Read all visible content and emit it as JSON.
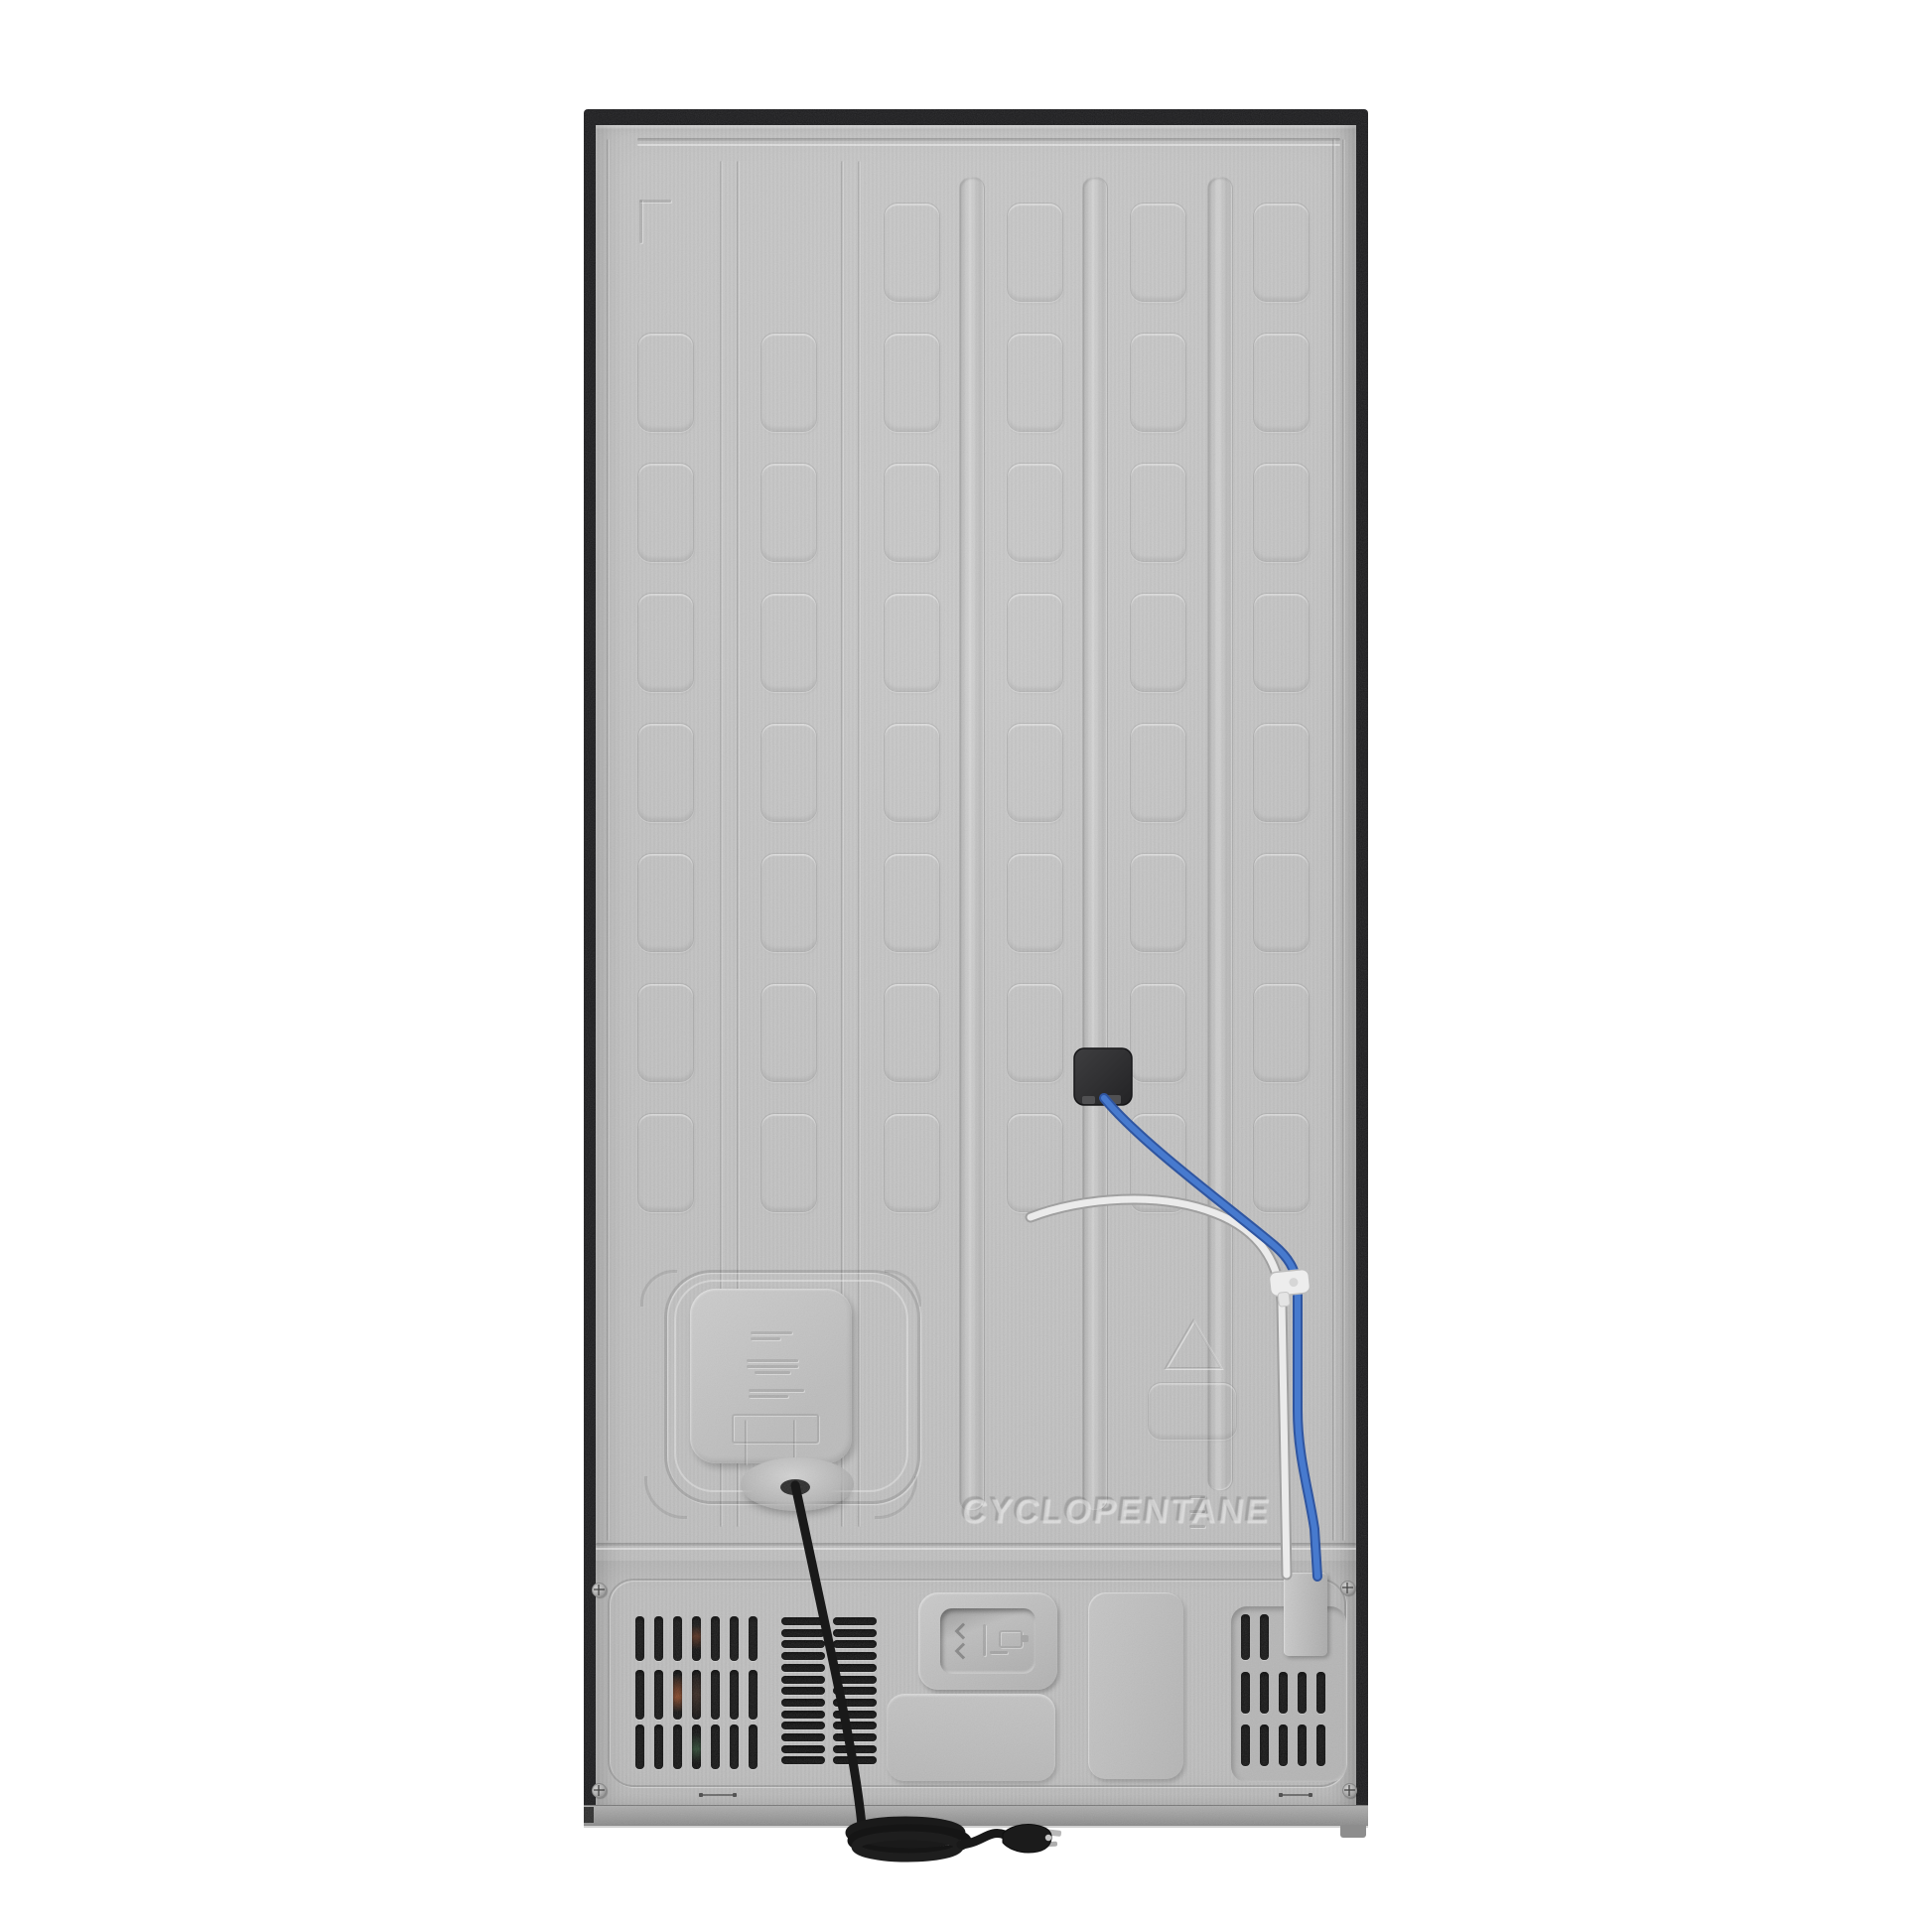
{
  "meta": {
    "title": "Refrigerator rear panel product photo",
    "canvas": "1946x1946"
  },
  "labels": {
    "refrigerant_text": "CYCLOPENTANE"
  },
  "colors": {
    "background": "#ffffff",
    "panel_gray": "#c5c5c5",
    "frame_black": "#1b1b1d",
    "kick_bar_gray": "#9a9a9a",
    "vent_slot_dark": "#151515",
    "power_cord_black": "#191919",
    "water_line_blue": "#3f6fc1",
    "water_line_blue_highlight": "#6b93d6",
    "drain_tube_white": "#ebebeb",
    "junction_box_dark": "#2e2e30",
    "clip_white": "#ededed"
  },
  "pattern": {
    "emboss_grid": {
      "columns": 6,
      "rows": 8,
      "top_row_first_column": 2
    },
    "left_vent": {
      "rows": 3,
      "columns": 7
    },
    "center_vent": {
      "rows": 13,
      "columns": 2
    },
    "right_vent": {
      "rows": 3,
      "slots_per_row": [
        2,
        5,
        5
      ]
    }
  },
  "parts": {
    "junction_box": "wiring junction box",
    "water_line": "blue water supply line",
    "drain_tube": "white drain tube",
    "clip": "tube retaining clip",
    "power_cord": "power cord with grounded plug",
    "access_plate": "drain / evaporator access plate",
    "compressor_area": "compressor compartment with vent grilles"
  }
}
